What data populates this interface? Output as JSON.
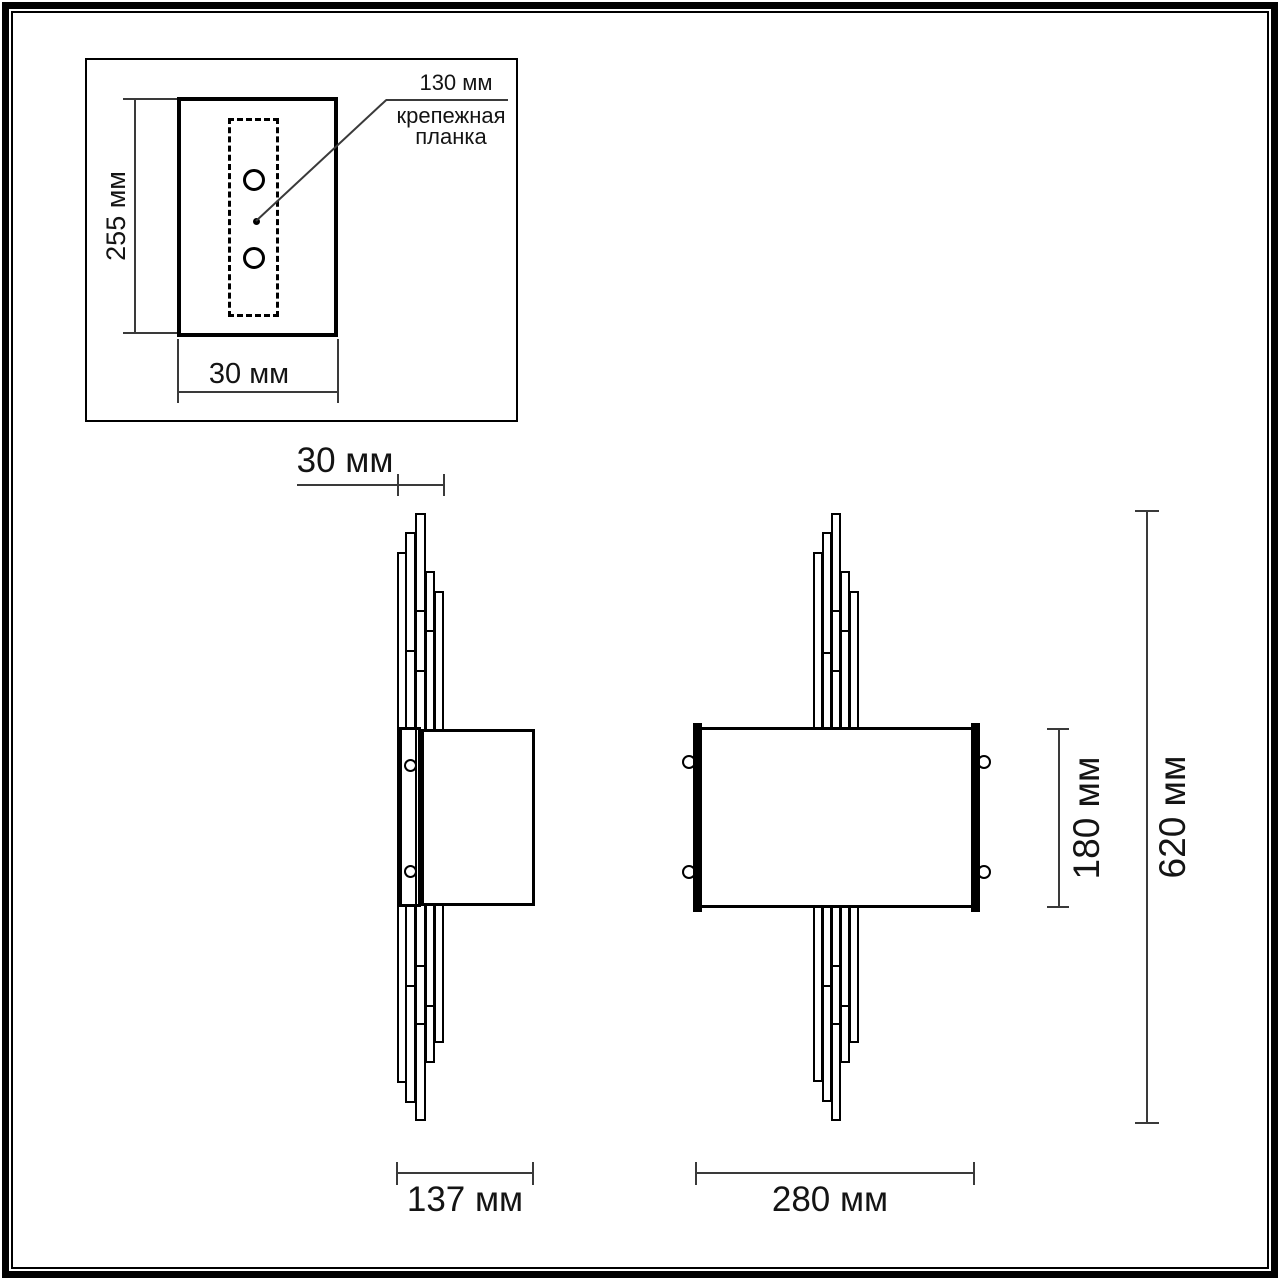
{
  "diagram": {
    "inset": {
      "height_label": "255 мм",
      "width_label": "30 мм",
      "holes_distance_label": "130 мм",
      "plate_label_line1": "крепежная",
      "plate_label_line2": "планка"
    },
    "side_view": {
      "depth_label": "30 мм",
      "width_label": "137 мм"
    },
    "front_view": {
      "width_label": "280 мм",
      "shade_height_label": "180 мм",
      "total_height_label": "620 мм"
    }
  },
  "colors": {
    "line": "#000000",
    "dim_line": "#3a3a3a",
    "background": "#ffffff"
  }
}
